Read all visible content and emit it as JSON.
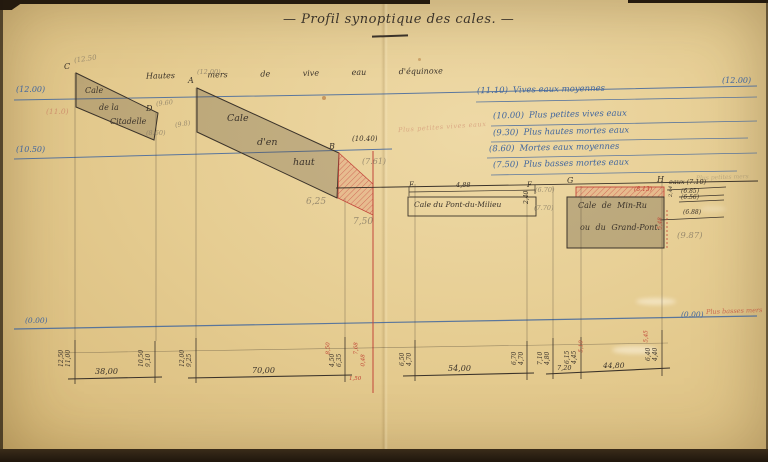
{
  "title": "— Profil synoptique des cales. —",
  "sea_caption": "Hautes mers de vive eau d'équinoxe",
  "levels": {
    "top_left": "(12.00)",
    "top_right": "(12.00)",
    "mid_left": "(10.50)",
    "near_b": "(10.40)",
    "zero_left": "(0.00)",
    "zero_right": "(0.00)",
    "zero_note": "Plus basses mers"
  },
  "tide_notes": [
    {
      "level": "(11.10)",
      "text": "Vives eaux moyennes"
    },
    {
      "level": "(10.00)",
      "text": "Plus petites vives eaux"
    },
    {
      "level": "(9.30)",
      "text": "Plus hautes mortes eaux"
    },
    {
      "level": "(8.60)",
      "text": "Mortes eaux moyennes"
    },
    {
      "level": "(7.50)",
      "text": "Plus basses mortes eaux"
    }
  ],
  "red_pencil_note": "Plus petites vives eaux",
  "points": {
    "a": "A",
    "b": "B",
    "c": "C",
    "d": "D",
    "e": "E",
    "f": "F",
    "g": "G",
    "h": "H"
  },
  "point_elevations": {
    "a": "(12.00)",
    "c": "(12.50",
    "d": "(9.60"
  },
  "cales": {
    "citadelle": [
      "Cale",
      "de la",
      "Citadelle"
    ],
    "haut": [
      "Cale",
      "d'en",
      "haut"
    ],
    "milieu": "Cale du Pont-du-Milieu",
    "milieu_width": "4,88",
    "milieu_depth": "2,40",
    "grand_pont_1": "Cale de Min-Ru",
    "grand_pont_2": "ou du Grand-Pont.",
    "grand_pont_red": "(8.13)"
  },
  "pencil": {
    "citadelle_red": "(11.0)",
    "d_upper": "(9.8)",
    "d_lower": "(8.60)",
    "haut_a": "6,25",
    "haut_b": "7,50",
    "near_b": "(7.61)",
    "milieu_a": "(6.70)",
    "milieu_b": "(7.70)",
    "grand_pont_depth": "(9.87)",
    "faint_right": "Plus petites mers"
  },
  "right_levels": {
    "l1": "eaux (7.10)",
    "l2": "(6.85)",
    "l3": "(6.56)",
    "l4": "(6.88)",
    "tick": "2,44",
    "red_v": "5,48"
  },
  "dims": {
    "spans": [
      "38,00",
      "70,00",
      "54,00",
      "7,20",
      "44,80"
    ],
    "posts": [
      "12,50",
      "11,00",
      "10,50",
      "9,10",
      "12,00",
      "9,25",
      "4,50",
      "6,35",
      "6,50",
      "4,70",
      "6,70",
      "4,70",
      "7,10",
      "4,80",
      "6,15",
      "4,45",
      "6,40",
      "4,40"
    ],
    "red": [
      "8,50",
      "7,68",
      "0,48",
      "1,50",
      "5,10",
      "5,45"
    ]
  }
}
